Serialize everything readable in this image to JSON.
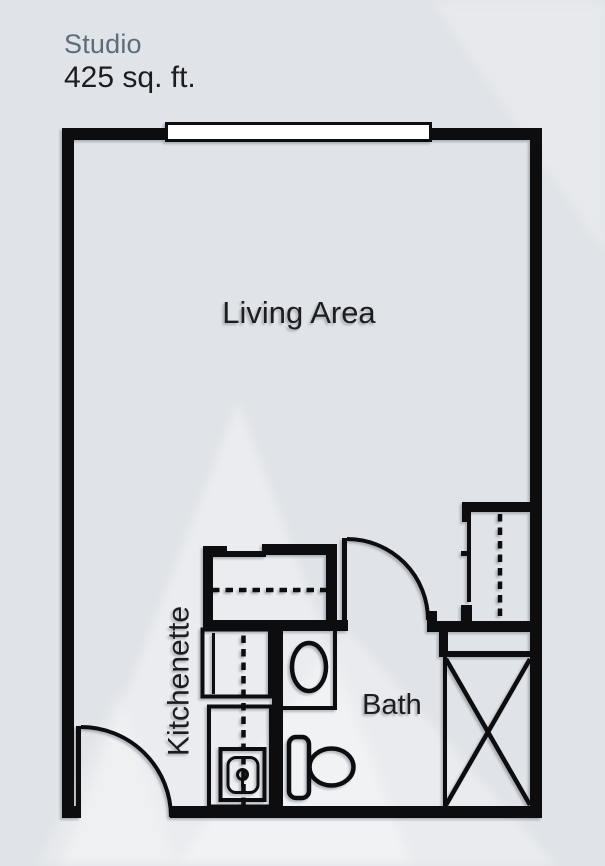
{
  "theme": {
    "background": "#e0e3e7",
    "wall": "#0d0d0f",
    "window_fill": "#ffffff",
    "title_color": "#5c6d79",
    "text_color": "#1d1d1f",
    "watermark": "#ffffff"
  },
  "header": {
    "title": "Studio",
    "area": "425 sq. ft."
  },
  "floorplan": {
    "labels": {
      "living_area": "Living Area",
      "kitchenette": "Kitchenette",
      "bath": "Bath"
    },
    "fixtures": [
      "window",
      "entry-door",
      "bath-door",
      "kitchenette-closet",
      "closet-shelf-dashed-line",
      "refrigerator",
      "kitchen-counter",
      "kitchen-sink",
      "kitchen-counter-dashed-line",
      "bath-vanity",
      "vanity-sink",
      "toilet",
      "wardrobe-closet",
      "closet-rod",
      "closet-shelf",
      "shower-x-box"
    ]
  }
}
